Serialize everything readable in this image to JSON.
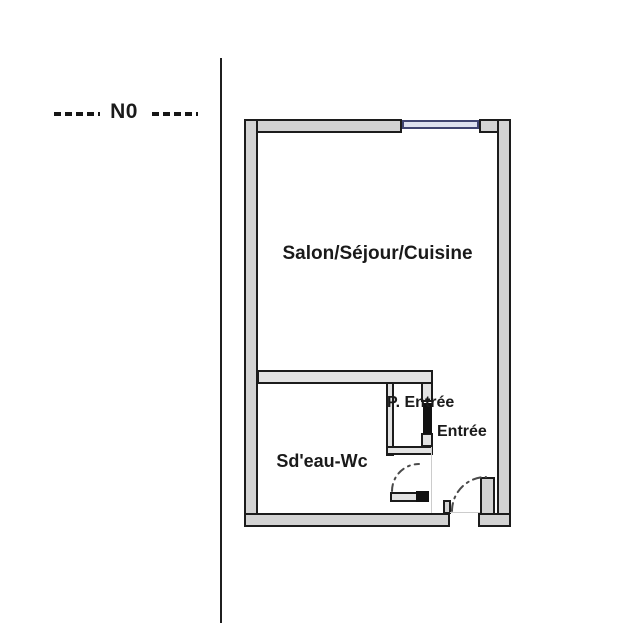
{
  "level_indicator": {
    "label": "N0"
  },
  "floor_plan": {
    "rooms": [
      {
        "name": "salon-sejour-cuisine",
        "label": "Salon/Séjour/Cuisine"
      },
      {
        "name": "sdeau-wc",
        "label": "Sd'eau-Wc"
      },
      {
        "name": "placard-entree",
        "label": "P. Entrée"
      },
      {
        "name": "entree",
        "label": "Entrée"
      }
    ],
    "features": [
      {
        "name": "window",
        "type": "window",
        "location": "top-wall"
      },
      {
        "name": "entrance-door",
        "type": "door-with-swing-arc",
        "location": "bottom-right"
      },
      {
        "name": "bathroom-door",
        "type": "door-with-swing-arc",
        "location": "sdeau-wc"
      },
      {
        "name": "closet-door",
        "type": "solid-black-door-bar",
        "location": "placard-entree"
      }
    ],
    "colors": {
      "wall_fill": "#d3d3d3",
      "interior_wall_fill": "#e3e3e3",
      "wall_outline": "#1c1c1c",
      "window_fill": "#dde1ef",
      "window_frame": "#3f4470",
      "door_arc": "#4a4a4a",
      "text": "#1a1a1a"
    }
  }
}
